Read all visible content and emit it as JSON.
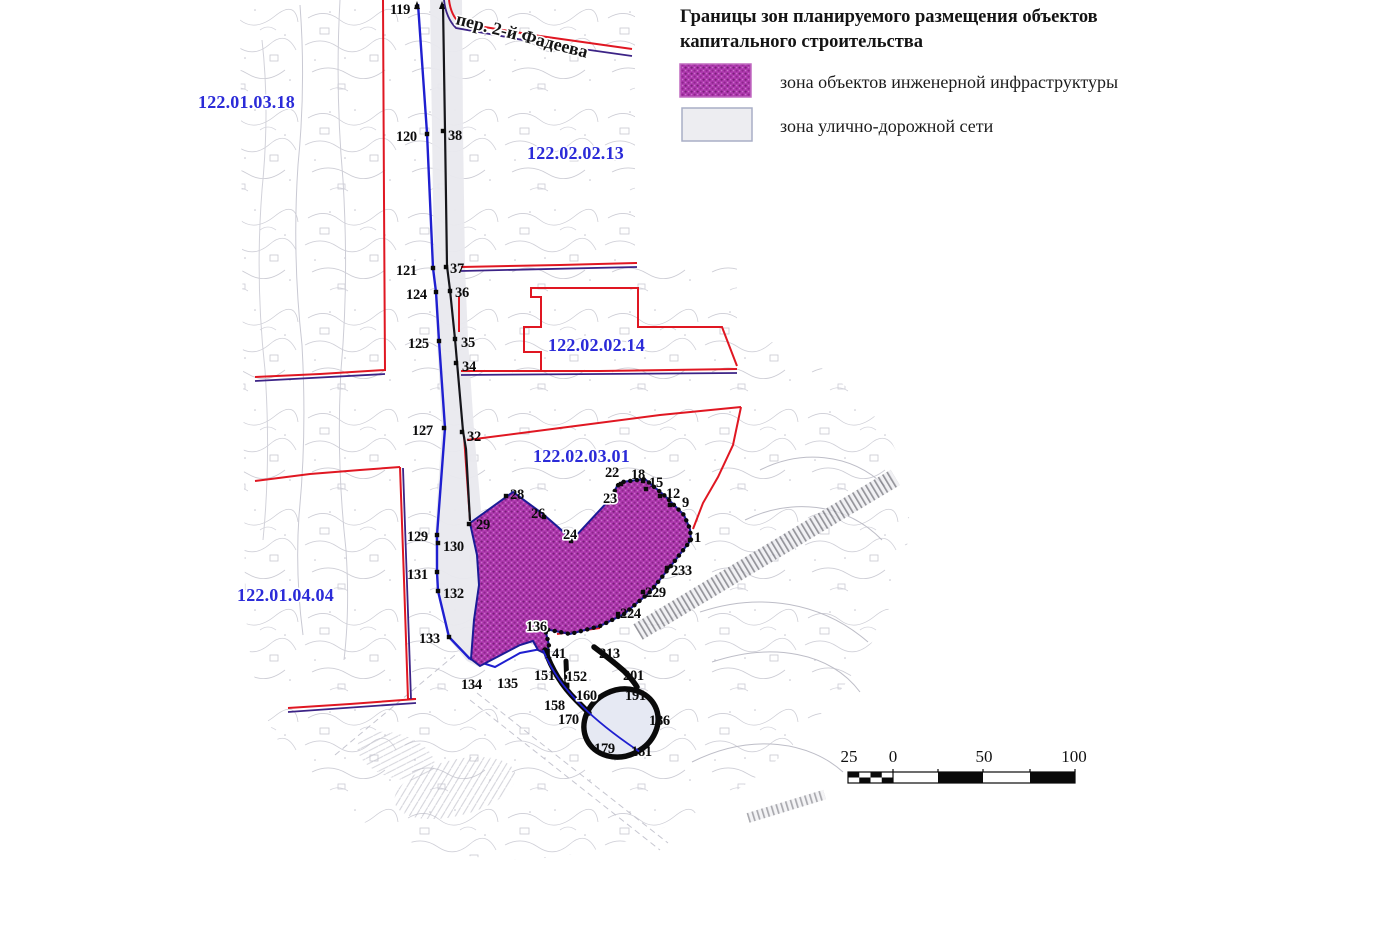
{
  "legend": {
    "title_line1": "Границы зон планируемого размещения объектов",
    "title_line2": "капитального строительства",
    "items": [
      {
        "label": "зона объектов инженерной инфраструктуры",
        "swatch": "engineering-infrastructure-hatch",
        "color": "#a832a8"
      },
      {
        "label": "зона улично-дорожной сети",
        "swatch": "street-road-network",
        "color": "#ededf1"
      }
    ]
  },
  "map": {
    "street_label": "пер. 2-й Фадеева",
    "zone_labels": [
      {
        "text": "122.01.03.18",
        "x": 198,
        "y": 108
      },
      {
        "text": "122.02.02.13",
        "x": 527,
        "y": 159
      },
      {
        "text": "122.02.02.14",
        "x": 548,
        "y": 351
      },
      {
        "text": "122.02.03.01",
        "x": 533,
        "y": 462
      },
      {
        "text": "122.01.04.04",
        "x": 237,
        "y": 601
      }
    ],
    "points": [
      {
        "n": "119",
        "lx": 390,
        "ly": 14,
        "mx": 417,
        "my": 7
      },
      {
        "n": "120",
        "lx": 396,
        "ly": 141,
        "mx": 427,
        "my": 134
      },
      {
        "n": "121",
        "lx": 396,
        "ly": 275,
        "mx": 433,
        "my": 268
      },
      {
        "n": "124",
        "lx": 406,
        "ly": 299,
        "mx": 436,
        "my": 292
      },
      {
        "n": "125",
        "lx": 408,
        "ly": 348,
        "mx": 439,
        "my": 341
      },
      {
        "n": "127",
        "lx": 412,
        "ly": 435,
        "mx": 444,
        "my": 428
      },
      {
        "n": "129",
        "lx": 407,
        "ly": 541,
        "mx": 437,
        "my": 535
      },
      {
        "n": "130",
        "lx": 443,
        "ly": 551,
        "mx": 438,
        "my": 543
      },
      {
        "n": "131",
        "lx": 407,
        "ly": 579,
        "mx": 437,
        "my": 572
      },
      {
        "n": "132",
        "lx": 443,
        "ly": 598,
        "mx": 438,
        "my": 591
      },
      {
        "n": "133",
        "lx": 419,
        "ly": 643,
        "mx": 449,
        "my": 637
      },
      {
        "n": "134",
        "lx": 461,
        "ly": 689
      },
      {
        "n": "135",
        "lx": 497,
        "ly": 688
      },
      {
        "n": "38",
        "lx": 448,
        "ly": 140,
        "mx": 443,
        "my": 131
      },
      {
        "n": "37",
        "lx": 450,
        "ly": 273,
        "mx": 446,
        "my": 267
      },
      {
        "n": "36",
        "lx": 455,
        "ly": 297,
        "mx": 450,
        "my": 291
      },
      {
        "n": "35",
        "lx": 461,
        "ly": 347,
        "mx": 455,
        "my": 339
      },
      {
        "n": "34",
        "lx": 462,
        "ly": 371,
        "mx": 456,
        "my": 363
      },
      {
        "n": "32",
        "lx": 467,
        "ly": 441,
        "mx": 462,
        "my": 432
      },
      {
        "n": "29",
        "lx": 476,
        "ly": 529,
        "mx": 469,
        "my": 524
      },
      {
        "n": "28",
        "lx": 510,
        "ly": 499,
        "mx": 506,
        "my": 496
      },
      {
        "n": "26",
        "lx": 531,
        "ly": 518,
        "mx": 544,
        "my": 517
      },
      {
        "n": "24",
        "lx": 563,
        "ly": 539,
        "halo": true,
        "mx": 571,
        "my": 541
      },
      {
        "n": "23",
        "lx": 603,
        "ly": 503,
        "halo": true,
        "mx": 612,
        "my": 500
      },
      {
        "n": "22",
        "lx": 605,
        "ly": 477,
        "mx": 621,
        "my": 484
      },
      {
        "n": "18",
        "lx": 631,
        "ly": 479,
        "mx": 643,
        "my": 481
      },
      {
        "n": "15",
        "lx": 649,
        "ly": 487,
        "mx": 646,
        "my": 489
      },
      {
        "n": "12",
        "lx": 666,
        "ly": 498,
        "mx": 660,
        "my": 496
      },
      {
        "n": "9",
        "lx": 682,
        "ly": 507,
        "mx": 670,
        "my": 505
      },
      {
        "n": "1",
        "lx": 694,
        "ly": 542,
        "mx": 690,
        "my": 540
      },
      {
        "n": "233",
        "lx": 671,
        "ly": 575,
        "mx": 667,
        "my": 568
      },
      {
        "n": "229",
        "lx": 645,
        "ly": 597,
        "mx": 643,
        "my": 592
      },
      {
        "n": "224",
        "lx": 620,
        "ly": 618,
        "mx": 618,
        "my": 614
      },
      {
        "n": "136",
        "lx": 526,
        "ly": 631,
        "halo": true
      },
      {
        "n": "141",
        "lx": 545,
        "ly": 658
      },
      {
        "n": "151",
        "lx": 534,
        "ly": 680
      },
      {
        "n": "152",
        "lx": 566,
        "ly": 681,
        "halo": true
      },
      {
        "n": "213",
        "lx": 599,
        "ly": 658
      },
      {
        "n": "201",
        "lx": 623,
        "ly": 680
      },
      {
        "n": "160",
        "lx": 576,
        "ly": 700,
        "halo": true
      },
      {
        "n": "191",
        "lx": 625,
        "ly": 700
      },
      {
        "n": "158",
        "lx": 544,
        "ly": 710
      },
      {
        "n": "170",
        "lx": 558,
        "ly": 724
      },
      {
        "n": "186",
        "lx": 649,
        "ly": 725
      },
      {
        "n": "179",
        "lx": 594,
        "ly": 753
      },
      {
        "n": "181",
        "lx": 631,
        "ly": 756
      }
    ]
  },
  "scale_bar": {
    "labels": [
      {
        "text": "25",
        "x": 849
      },
      {
        "text": "0",
        "x": 893
      },
      {
        "text": "50",
        "x": 984
      },
      {
        "text": "100",
        "x": 1074
      }
    ],
    "y": 762
  },
  "colors": {
    "boundary_red": "#e01722",
    "line_blue": "#1f1fd0",
    "pair_dark": "#3c2386",
    "zone_label_blue": "#2b2bd8",
    "zone_magenta": "#a832a8"
  }
}
